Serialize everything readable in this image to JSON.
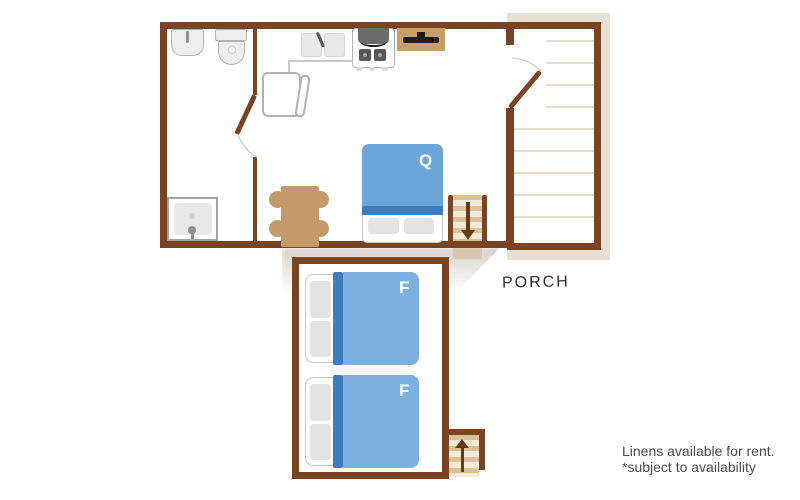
{
  "plan": {
    "rooms": {
      "porch_label": "PORCH"
    },
    "beds": {
      "queen_label": "Q",
      "full1_label": "F",
      "full2_label": "F"
    },
    "note": {
      "line1": "Linens available for rent.",
      "line2": "*subject to availability"
    },
    "icons": {
      "main_stairs": "down-arrow",
      "lower_stairs": "up-arrow"
    },
    "colors": {
      "wall": "#7a4423",
      "q-blue": "#6ba6d8",
      "f-blue": "#7db0dc",
      "bed-dark-blue": "#3c7ec5",
      "wood": "#c59a6b",
      "deck-frame": "#e8e1d3",
      "deck-line": "#e6dbc4",
      "tread-dark": "#dcc096",
      "tread-light": "#f3ebd9",
      "arrow": "#6a3a18",
      "fixture-fill": "#ededed",
      "fixture-border": "#b2b2b2",
      "pillow": "#e3e3e3",
      "text-dark": "#2f2f2f",
      "text-note": "#4b4b4b"
    }
  }
}
